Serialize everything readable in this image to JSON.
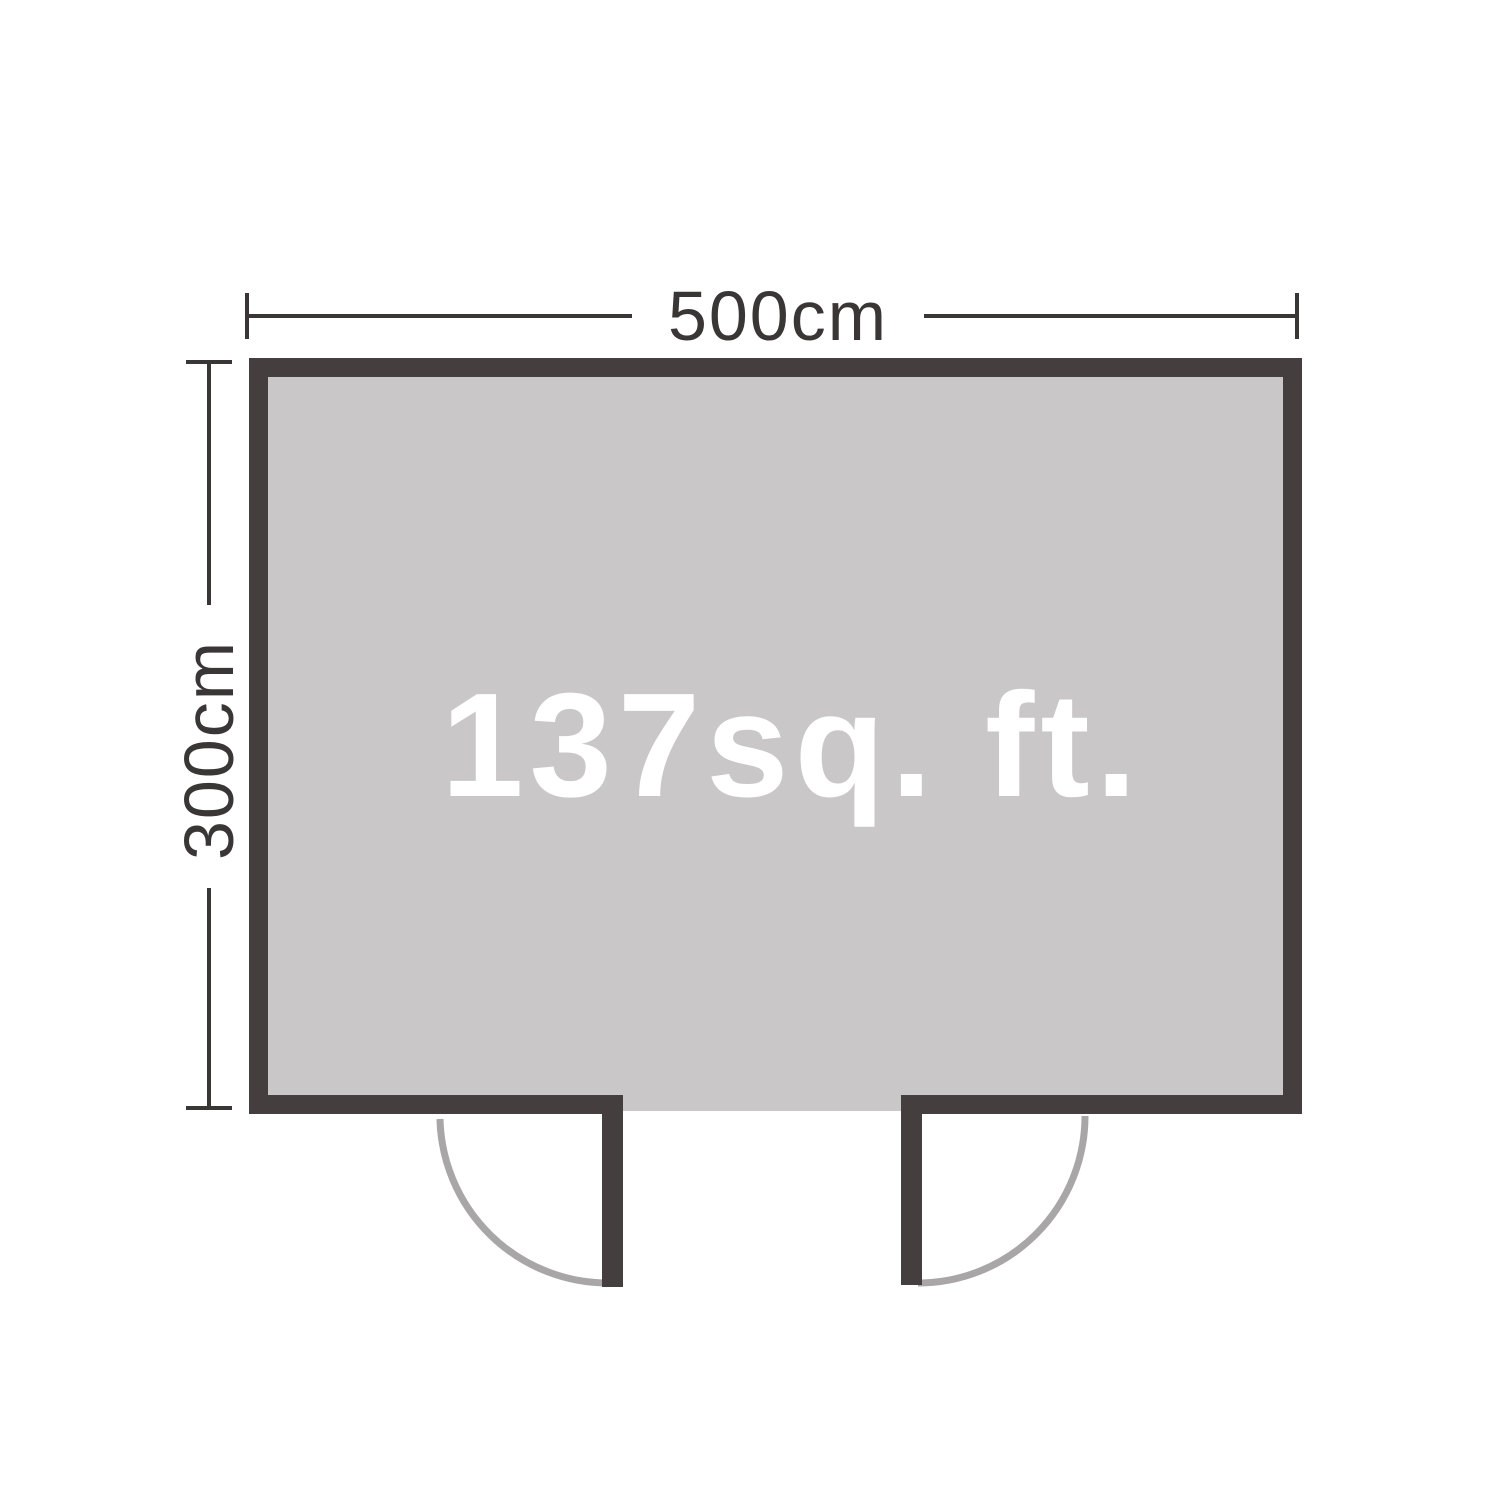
{
  "floor_plan": {
    "type": "shed-top-down-floor-plan",
    "width_label": "500cm",
    "depth_label": "300cm",
    "area_label": "137sq. ft.",
    "doors": 2,
    "colors": {
      "wall": "#453e3e",
      "floor": "#c9c7c8",
      "arc": "#a8a6a7",
      "dim": "#3a3636",
      "area_text": "#ffffff",
      "background": "#ffffff"
    }
  }
}
